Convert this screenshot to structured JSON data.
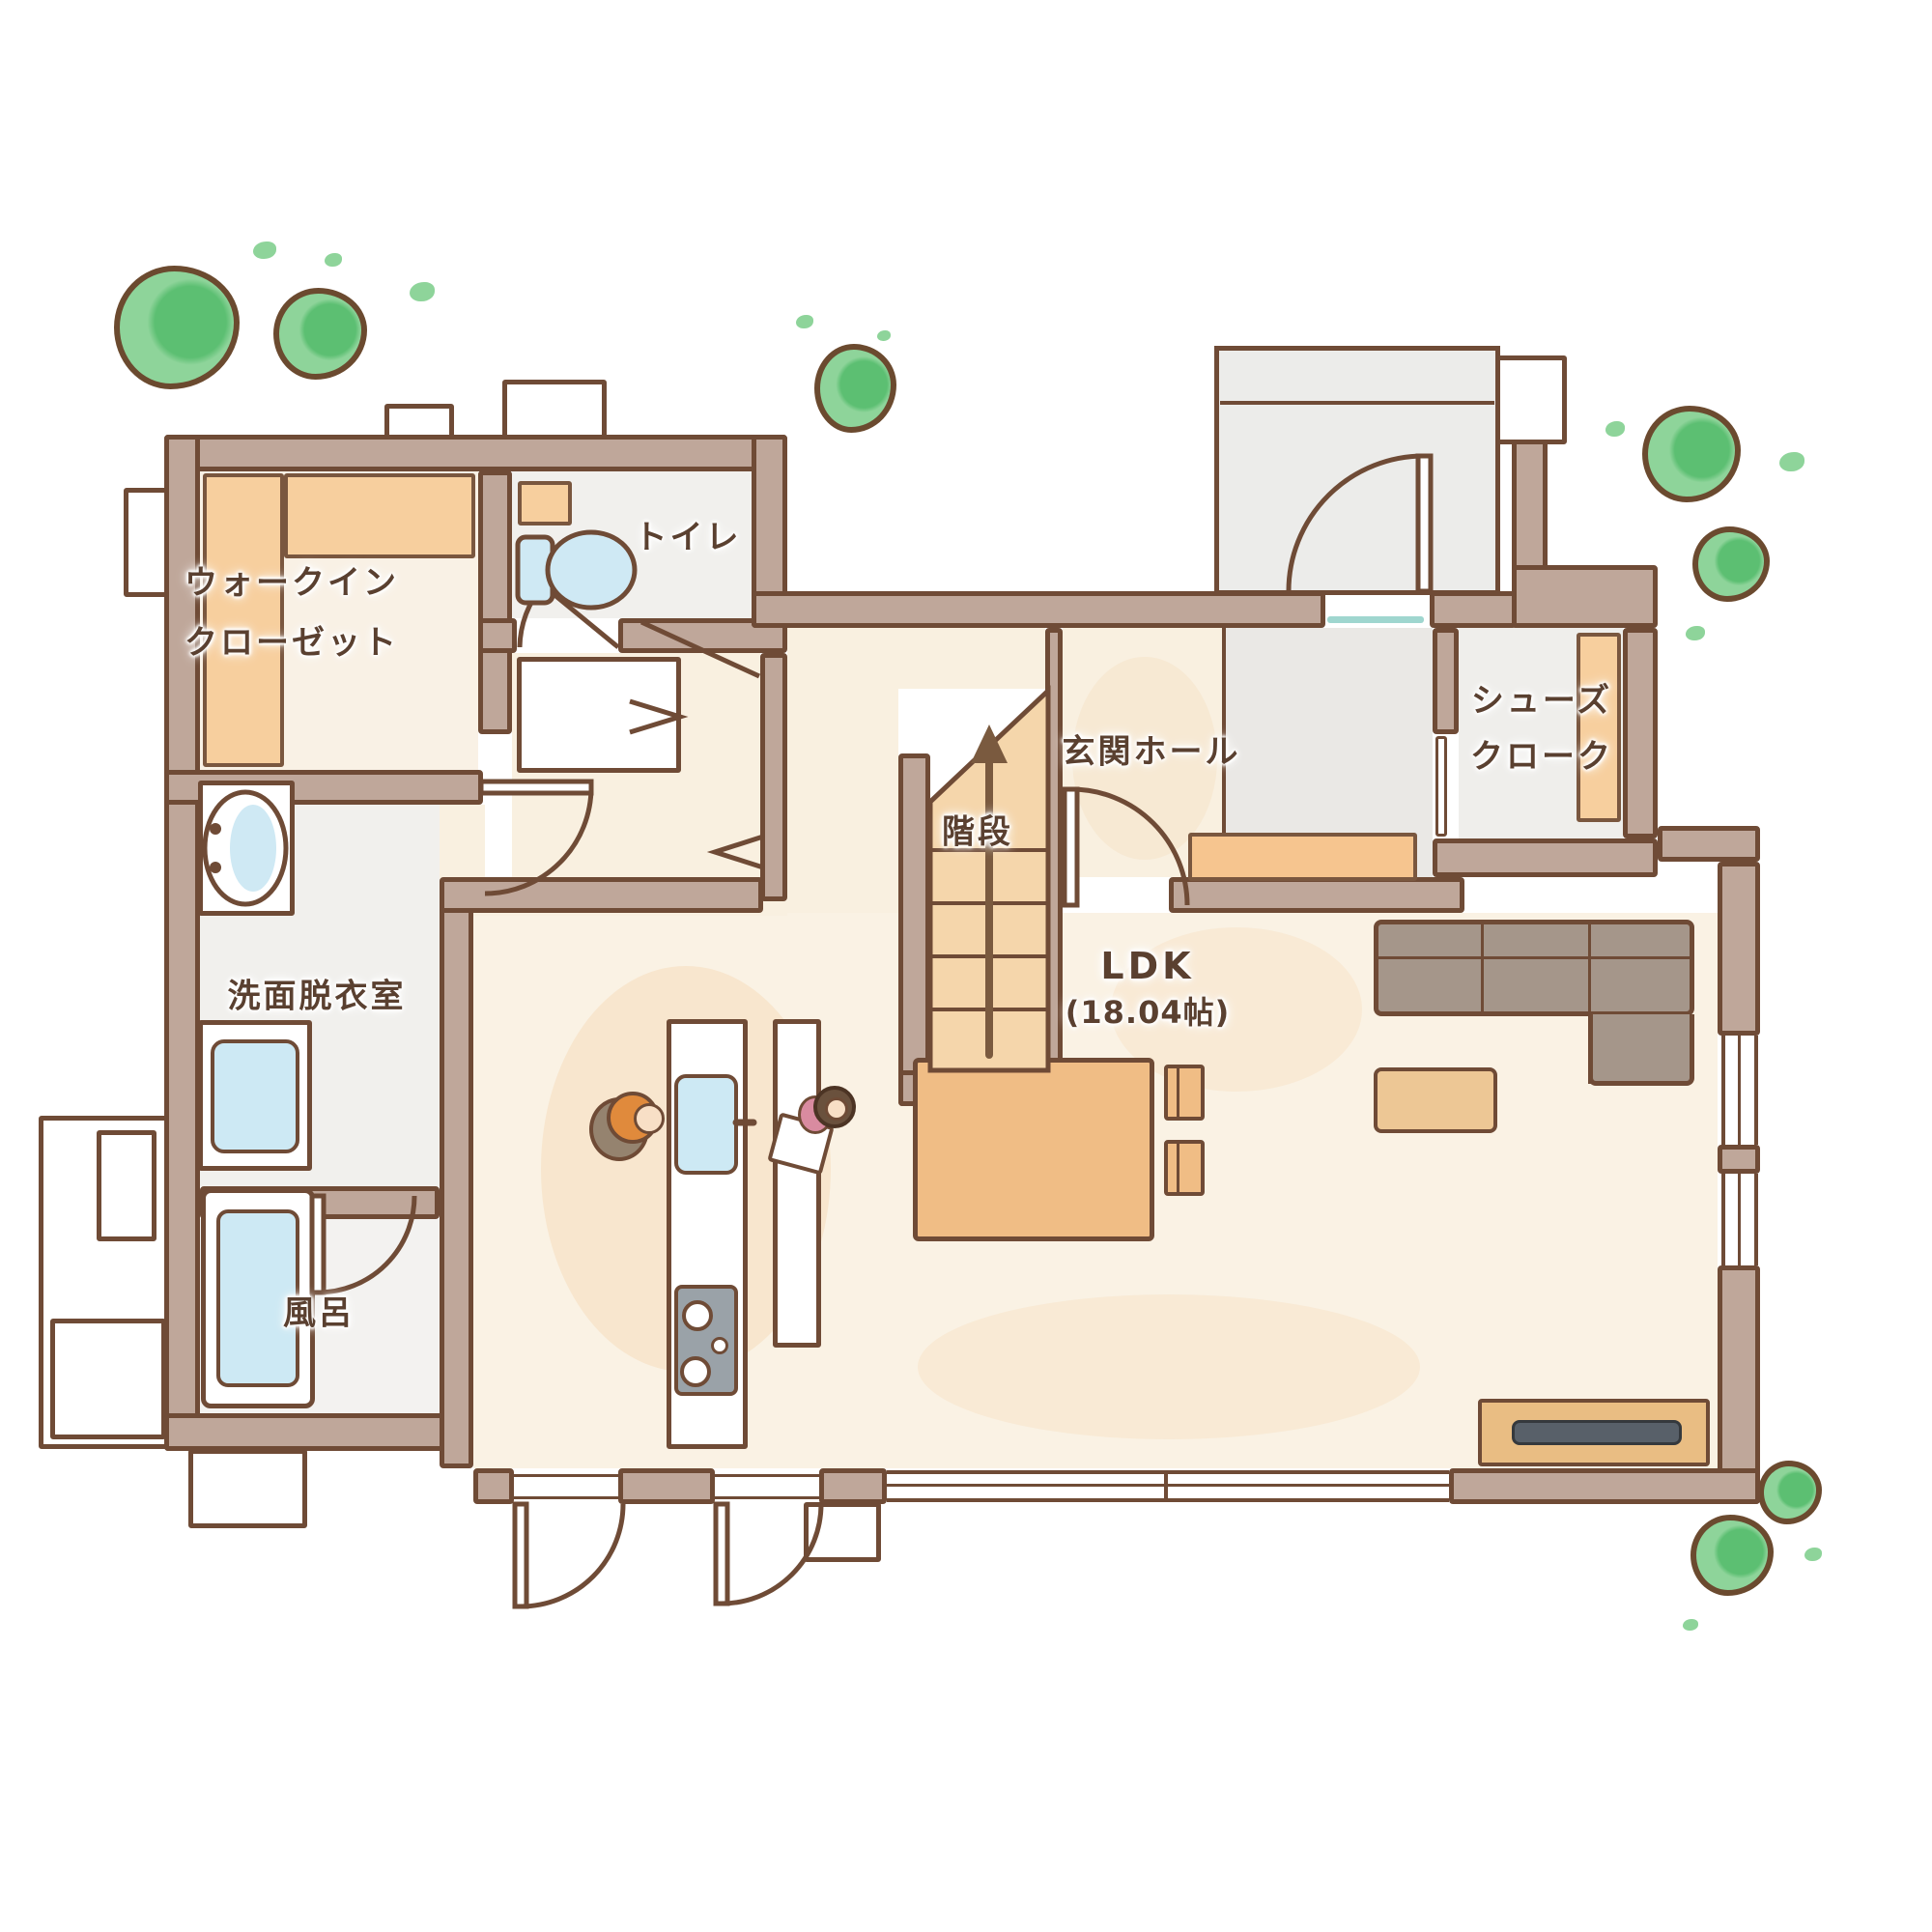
{
  "plan": {
    "title": "1F間取り図",
    "rooms": {
      "walk_in_closet": {
        "label_line1": "ウォークイン",
        "label_line2": "クローゼット"
      },
      "toilet": {
        "label": "トイレ"
      },
      "entrance_hall": {
        "label": "玄関ホール"
      },
      "shoe_cloak": {
        "label_line1": "シューズ",
        "label_line2": "クローク"
      },
      "stairs": {
        "label": "階段"
      },
      "washroom": {
        "label": "洗面脱衣室"
      },
      "bath": {
        "label": "風呂"
      },
      "ldk": {
        "label": "LDK",
        "size": "(18.04帖)"
      }
    },
    "icons": {
      "toilet": "toilet-top-view",
      "bathtub": "bathtub-top-view",
      "vanity": "washbasin-oval",
      "washing_machine": "washing-machine",
      "kitchen_sink": "kitchen-sink",
      "stove": "gas-stove-3-burner",
      "sofa": "l-shaped-sofa",
      "dining_table": "dining-table",
      "tv": "tv-on-board",
      "trees": "garden-bush",
      "people": [
        "parent-cooking",
        "child-at-counter"
      ]
    },
    "colors": {
      "wall": "#bfa79a",
      "wall_outline": "#6f4b36",
      "floor_warm": "#f9f0e0",
      "floor_gray": "#f1f0ed",
      "shelf_orange": "#f7cf9e",
      "stairs_orange": "#f5d6ab",
      "water_blue": "#cde9f4",
      "greenery": "#8ed49a",
      "sofa_gray": "#a5968a",
      "wood": "#f0bd85",
      "tv_dark": "#586069",
      "text": "#5a4030"
    }
  }
}
